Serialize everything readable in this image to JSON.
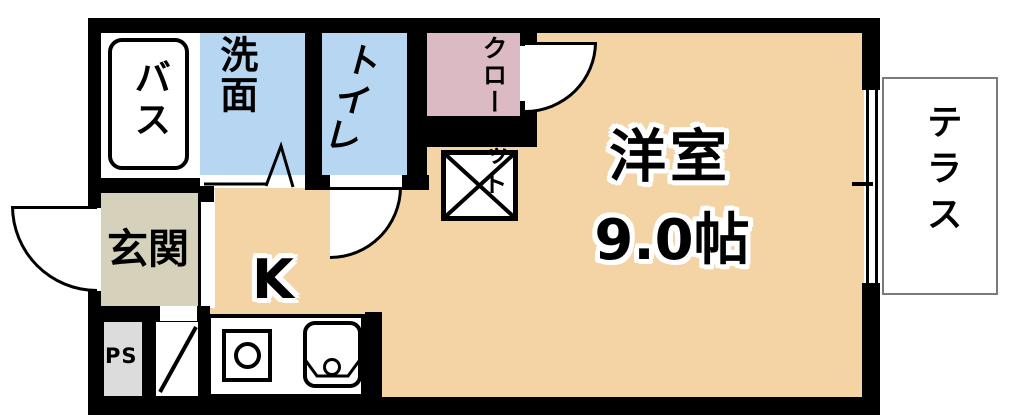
{
  "title": "1R apartment floor plan",
  "rooms": {
    "bath": {
      "label": "バス"
    },
    "washroom": {
      "label": "洗面"
    },
    "toilet": {
      "label": "トイレ"
    },
    "closet": {
      "label": "クローゼット"
    },
    "main_room": {
      "label": "洋室",
      "size": "9.0帖"
    },
    "kitchen": {
      "label": "K"
    },
    "entrance": {
      "label": "玄関"
    },
    "pipe_space": {
      "label": "PS"
    },
    "terrace": {
      "label": "テラス"
    }
  },
  "colors": {
    "wall": "#000000",
    "main_floor": "#f4d4a4",
    "wet_area_floor": "#b6d6f2",
    "closet_floor": "#dbbac3",
    "entrance_floor": "#d5d1ba",
    "pipe_space_fill": "#dcdcdc",
    "terrace_border": "#7a7a7a"
  }
}
